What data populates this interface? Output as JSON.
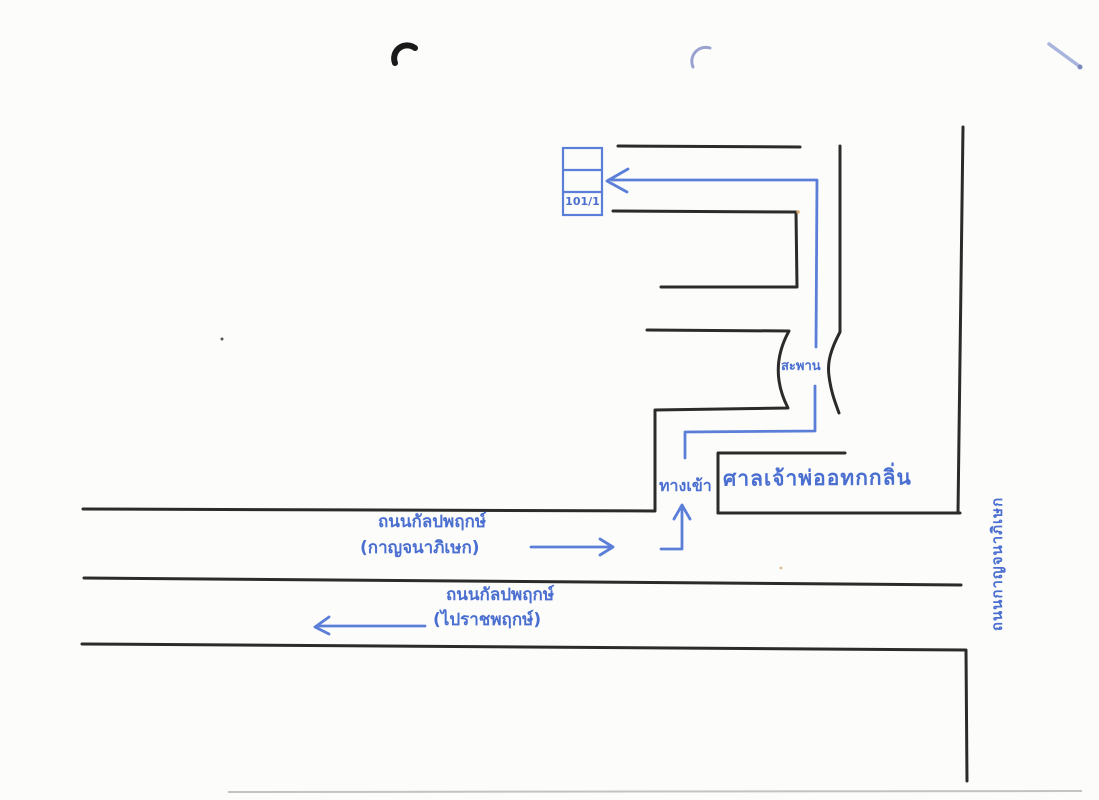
{
  "colors": {
    "ink_blue": "#4a6fd0",
    "route_blue": "#5b7fd8",
    "ink_black": "#2b2b2b",
    "paper": "#fcfcfa",
    "pen_mark_blue": "#a9b4dd"
  },
  "map": {
    "house": {
      "number": "101/1"
    },
    "bridge_label": "สะพาน",
    "entrance_label": "ทางเข้า",
    "shrine_label": "ศาลเจ้าพ่ออทกกลิ่น",
    "roads": {
      "kalpapruek_eastbound": {
        "name": "ถนนกัลปพฤกษ์",
        "direction": "(กาญจนาภิเษก)"
      },
      "kalpapruek_westbound": {
        "name": "ถนนกัลปพฤกษ์",
        "direction": "(ไปราชพฤกษ์)"
      },
      "kanchanaphisek": {
        "name": "ถนนกาญจนาภิเษก"
      }
    }
  }
}
